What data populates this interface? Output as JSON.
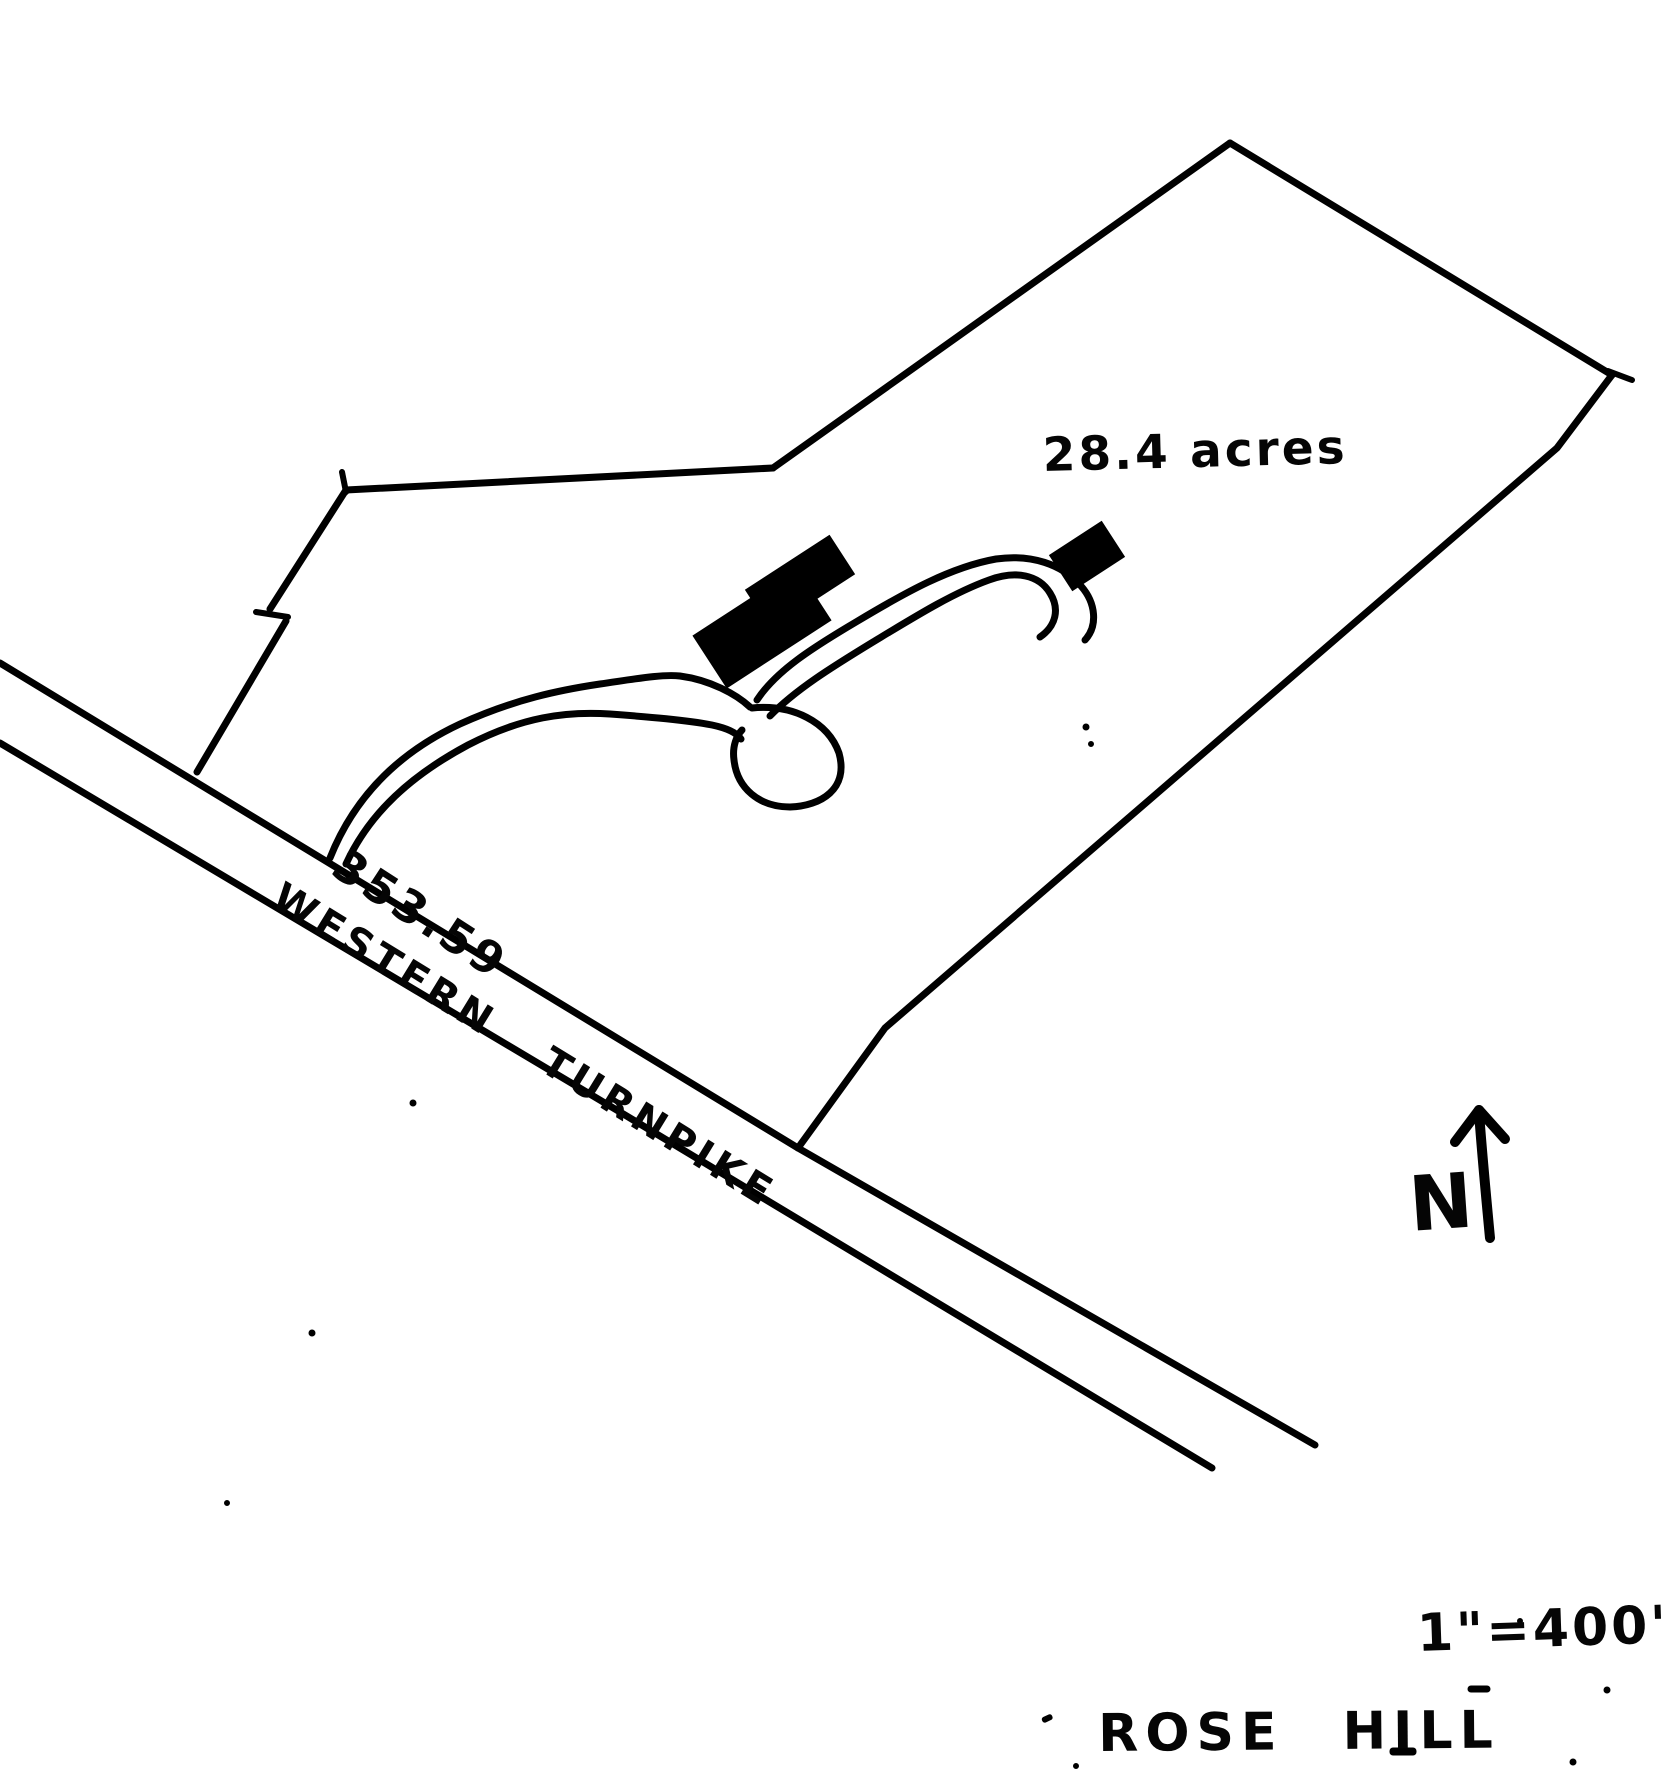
{
  "sketch": {
    "acreage_label": "28.4 acres",
    "frontage_label": "353.59",
    "road_name": "WESTERN TURNPIKE",
    "north_label": "N",
    "scale_label": "1\"=400'",
    "title": "ROSE HILL"
  },
  "colors": {
    "ink": "#000000",
    "paper": "#ffffff"
  }
}
